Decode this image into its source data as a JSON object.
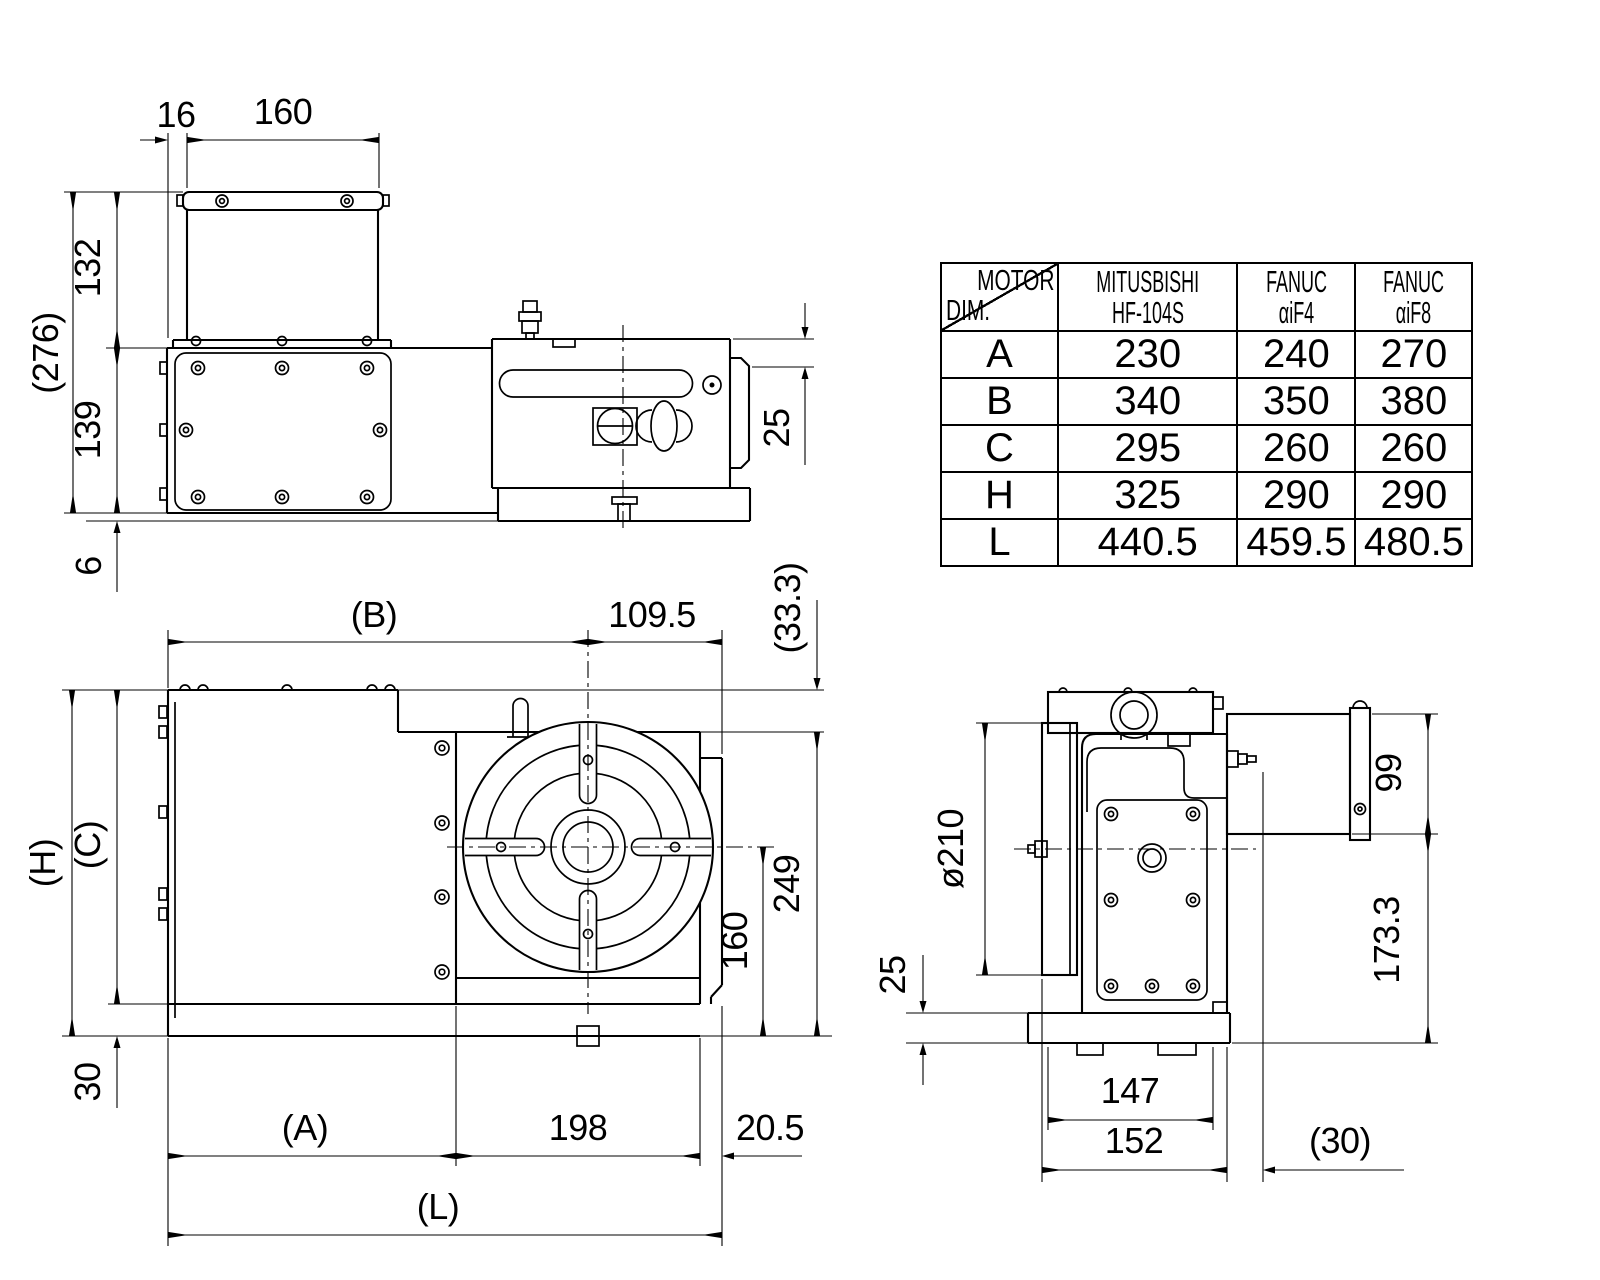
{
  "meta": {
    "ink_color": "#000000",
    "paper_color": "#ffffff"
  },
  "views": {
    "top": {
      "dims": {
        "w16": "16",
        "w160": "160",
        "h276": "(276)",
        "h132": "132",
        "h139": "139",
        "h6": "6",
        "d25": "25"
      }
    },
    "front": {
      "dims": {
        "B": "(B)",
        "d1095": "109.5",
        "d333": "(33.3)",
        "H": "(H)",
        "C": "(C)",
        "d249": "249",
        "d160": "160",
        "d30": "30",
        "A": "(A)",
        "d198": "198",
        "d205": "20.5",
        "L": "(L)"
      }
    },
    "side": {
      "dims": {
        "dia": "ø210",
        "d25": "25",
        "d99": "99",
        "d1733": "173.3",
        "d147": "147",
        "d152": "152",
        "d30": "(30)"
      }
    }
  },
  "spec_table": {
    "corner_top": "MOTOR",
    "corner_bottom": "DIM.",
    "columns": [
      {
        "line1": "MITUSBISHI",
        "line2": "HF-104S"
      },
      {
        "line1": "FANUC",
        "line2": "αiF4"
      },
      {
        "line1": "FANUC",
        "line2": "αiF8"
      }
    ],
    "rows": [
      {
        "dim": "A",
        "values": [
          "230",
          "240",
          "270"
        ]
      },
      {
        "dim": "B",
        "values": [
          "340",
          "350",
          "380"
        ]
      },
      {
        "dim": "C",
        "values": [
          "295",
          "260",
          "260"
        ]
      },
      {
        "dim": "H",
        "values": [
          "325",
          "290",
          "290"
        ]
      },
      {
        "dim": "L",
        "values": [
          "440.5",
          "459.5",
          "480.5"
        ]
      }
    ]
  }
}
